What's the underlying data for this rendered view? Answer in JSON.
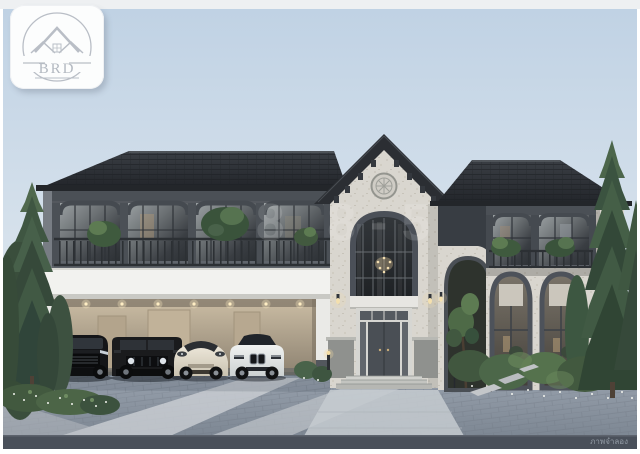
{
  "image": {
    "caption": "ภาพจำลอง",
    "watermark": "8 8-5"
  },
  "logo": {
    "brand": "BRD"
  },
  "palette": {
    "sky_top": "#c0d2e4",
    "sky_bottom": "#eaeef1",
    "roof_dark": "#2b2e33",
    "stone_light": "#d9d6cf",
    "facade_frame_gray": "#60656c",
    "carport_white": "#f2f2ef",
    "carport_wall_beige": "#c7b89f",
    "foliage_dark": "#3f5340",
    "foliage_light": "#5d7b52",
    "pavement_blue_gray": "#8e98a4",
    "pavement_stripe": "#ccd0d5",
    "road_dark": "#4a505a",
    "warm_light": "#f0ddb0",
    "logo_line_gray": "#b9bec6",
    "caption_gray": "#9aa3ad"
  }
}
